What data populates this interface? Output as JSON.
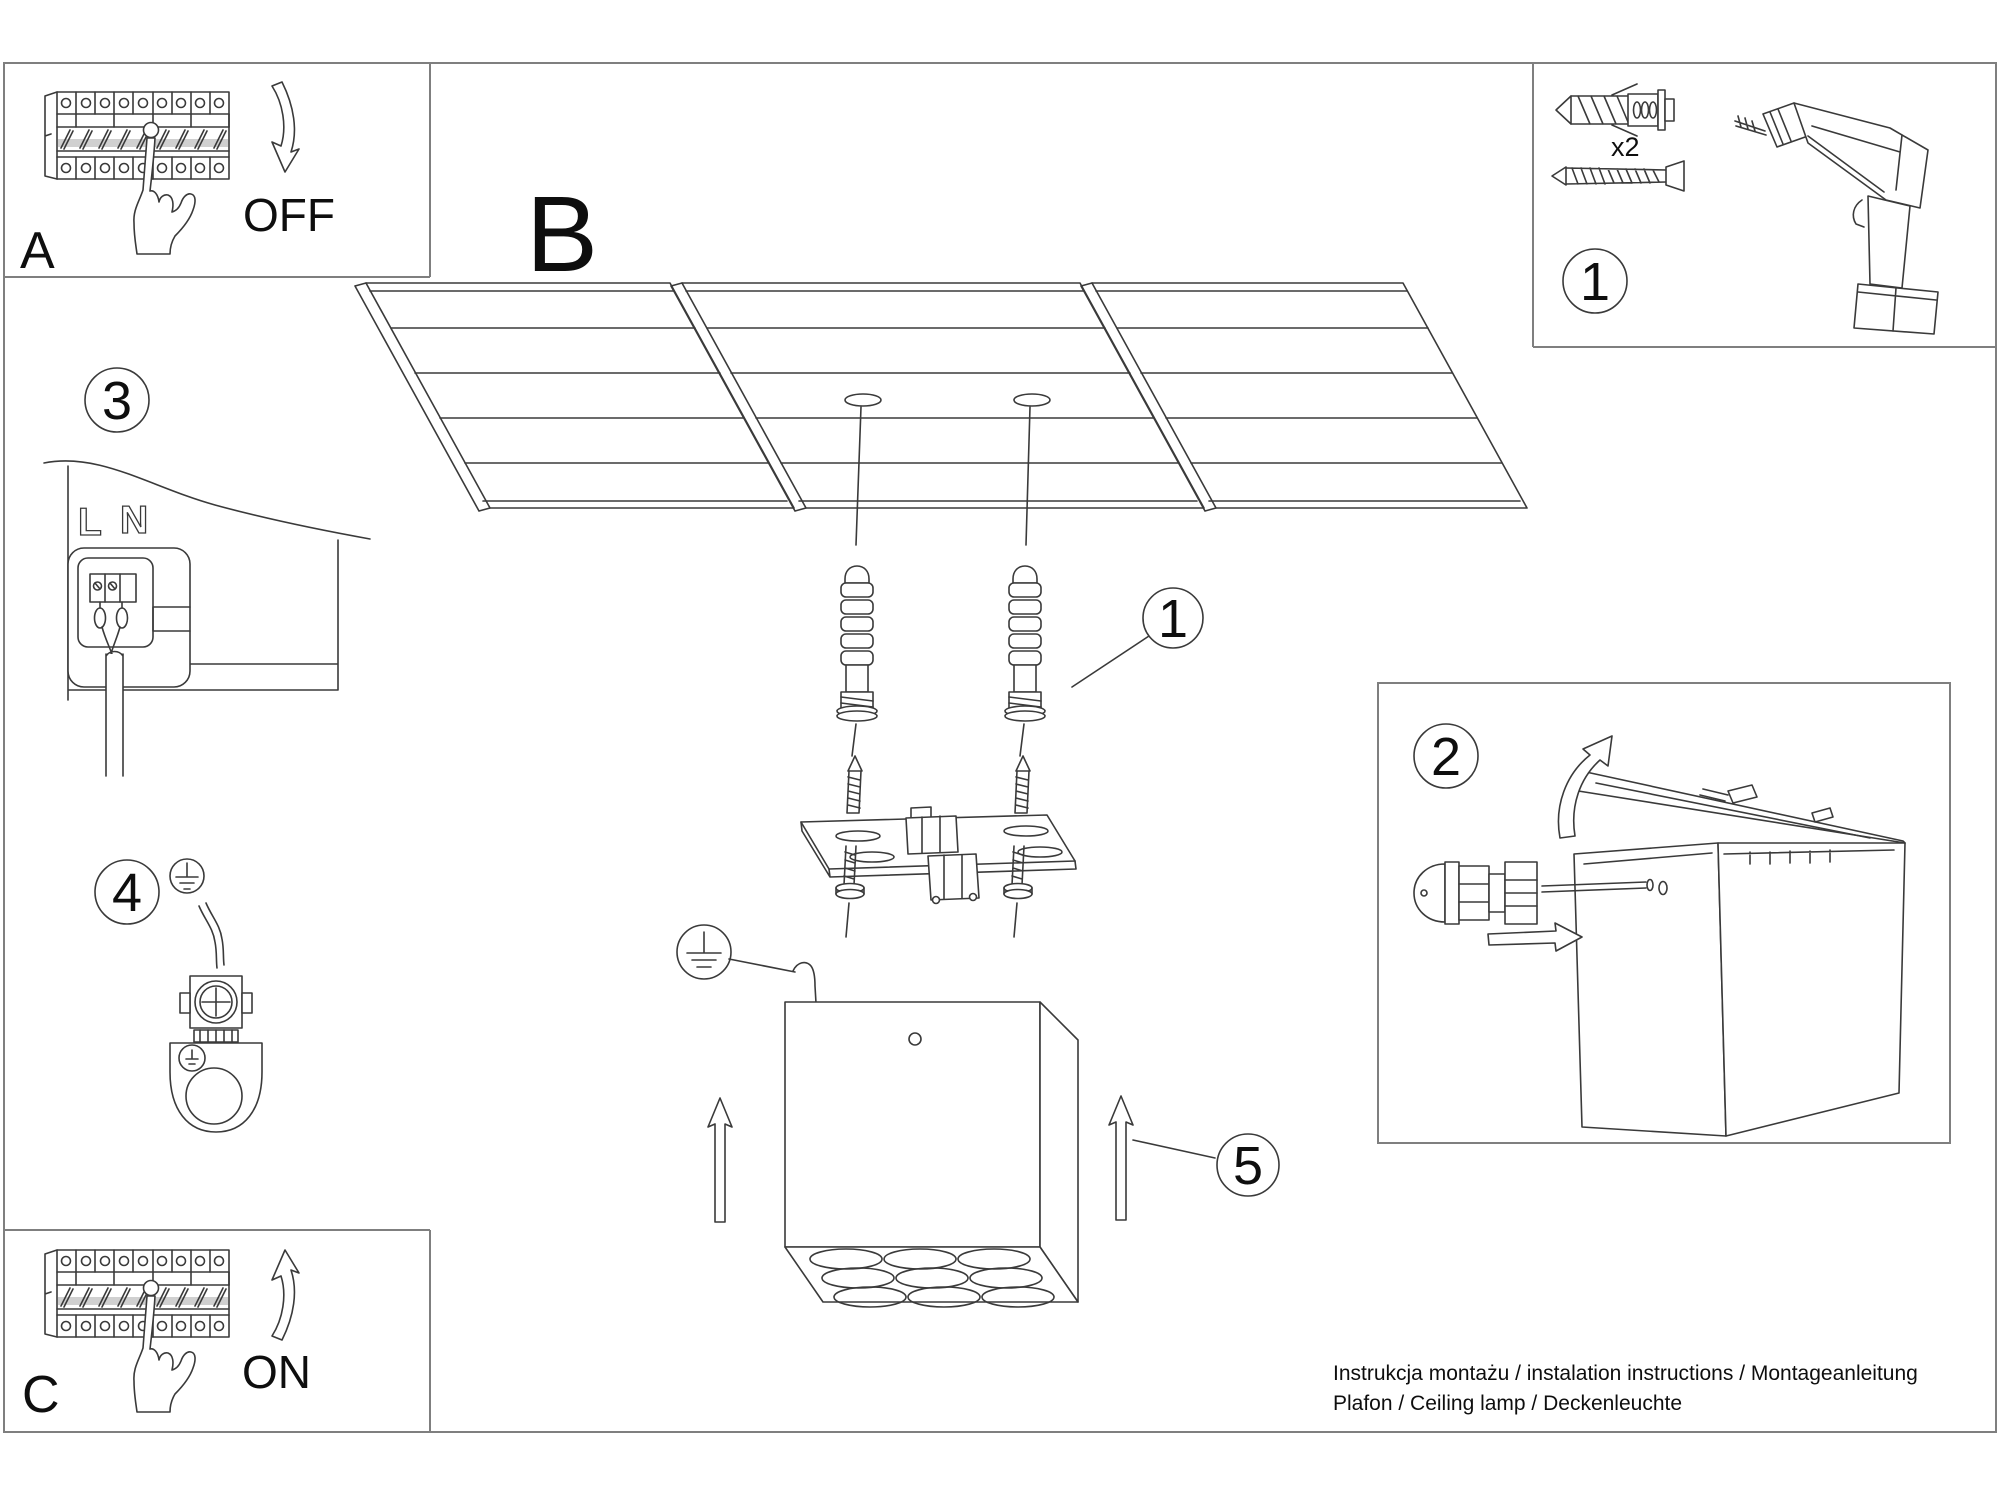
{
  "document": {
    "footer": {
      "line1": "Instrukcja montażu / instalation instructions / Montageanleitung",
      "line2": "Plafon / Ceiling lamp / Deckenleuchte"
    },
    "colors": {
      "ink": "#3a3a3a",
      "frame": "#7f7f7f",
      "paper": "#ffffff"
    }
  },
  "panels": {
    "breaker_off": {
      "letter": "A",
      "state": "OFF"
    },
    "ceiling_overview": {
      "letter": "B"
    },
    "breaker_on": {
      "letter": "C",
      "state": "ON"
    },
    "hardware": {
      "step": "1",
      "qty": "x2"
    },
    "cable_gland": {
      "step": "2"
    },
    "mains_wiring": {
      "step": "3",
      "live": "L",
      "neutral": "N"
    },
    "grounding": {
      "step": "4"
    }
  },
  "callouts": {
    "anchors_step": "1",
    "mount_step": "5"
  }
}
